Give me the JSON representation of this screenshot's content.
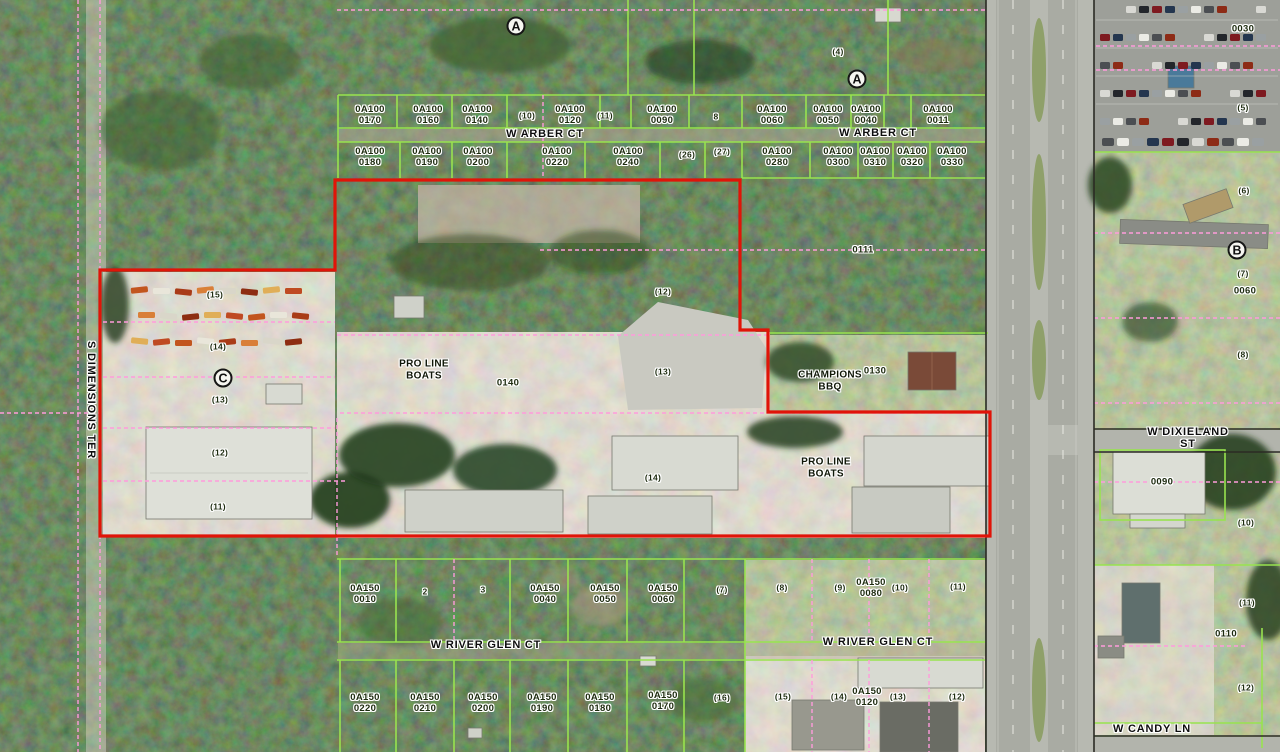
{
  "map": {
    "type": "county-gis-aerial-parcel-map",
    "colors": {
      "parcel_line_green": "#98e34f",
      "lot_boundary_pink": "#ff9bdc",
      "selected_parcel_red": "#e01408",
      "right_of_way_black": "#2b2b24",
      "label_ink": "#1d2b0f",
      "road_gray": "#b7b9b1"
    },
    "area_markers": [
      {
        "letter": "A",
        "x": 516,
        "y": 26
      },
      {
        "letter": "A",
        "x": 857,
        "y": 79
      },
      {
        "letter": "B",
        "x": 1237,
        "y": 250
      },
      {
        "letter": "C",
        "x": 223,
        "y": 378
      }
    ],
    "street_labels": [
      {
        "text": "W ARBER CT",
        "x": 545,
        "y": 134
      },
      {
        "text": "W ARBER CT",
        "x": 878,
        "y": 133
      },
      {
        "text": "S DIMENSIONS TER",
        "x": 91,
        "y": 400,
        "vertical": true
      },
      {
        "text": "W DIXIELAND ST",
        "x": 1188,
        "y": 438
      },
      {
        "text": "W RIVER GLEN CT",
        "x": 486,
        "y": 645
      },
      {
        "text": "W RIVER GLEN CT",
        "x": 878,
        "y": 642
      },
      {
        "text": "W CANDY LN",
        "x": 1152,
        "y": 729
      }
    ],
    "business_labels": [
      {
        "text": "PRO LINE\nBOATS",
        "x": 424,
        "y": 370
      },
      {
        "text": "CHAMPIONS\nBBQ",
        "x": 830,
        "y": 381
      },
      {
        "text": "PRO LINE\nBOATS",
        "x": 826,
        "y": 468
      }
    ],
    "parcel_labels": [
      {
        "text": "0A100\n0170",
        "x": 370,
        "y": 115
      },
      {
        "text": "0A100\n0160",
        "x": 428,
        "y": 115
      },
      {
        "text": "0A100\n0140",
        "x": 477,
        "y": 115
      },
      {
        "text": "0A100\n0120",
        "x": 570,
        "y": 115
      },
      {
        "text": "0A100\n0090",
        "x": 662,
        "y": 115
      },
      {
        "text": "0A100\n0060",
        "x": 772,
        "y": 115
      },
      {
        "text": "0A100\n0050",
        "x": 828,
        "y": 115
      },
      {
        "text": "0A100\n0040",
        "x": 866,
        "y": 115
      },
      {
        "text": "0A100\n0011",
        "x": 938,
        "y": 115
      },
      {
        "text": "0A100\n0180",
        "x": 370,
        "y": 157
      },
      {
        "text": "0A100\n0190",
        "x": 427,
        "y": 157
      },
      {
        "text": "0A100\n0200",
        "x": 478,
        "y": 157
      },
      {
        "text": "0A100\n0220",
        "x": 557,
        "y": 157
      },
      {
        "text": "0A100\n0240",
        "x": 628,
        "y": 157
      },
      {
        "text": "0A100\n0280",
        "x": 777,
        "y": 157
      },
      {
        "text": "0A100\n0300",
        "x": 838,
        "y": 157
      },
      {
        "text": "0A100\n0310",
        "x": 875,
        "y": 157
      },
      {
        "text": "0A100\n0320",
        "x": 912,
        "y": 157
      },
      {
        "text": "0A100\n0330",
        "x": 952,
        "y": 157
      },
      {
        "text": "0111",
        "x": 863,
        "y": 250
      },
      {
        "text": "0140",
        "x": 508,
        "y": 383
      },
      {
        "text": "0130",
        "x": 875,
        "y": 371
      },
      {
        "text": "0030",
        "x": 1243,
        "y": 29
      },
      {
        "text": "0060",
        "x": 1245,
        "y": 291
      },
      {
        "text": "0090",
        "x": 1162,
        "y": 482
      },
      {
        "text": "0110",
        "x": 1226,
        "y": 634
      },
      {
        "text": "0A150\n0010",
        "x": 365,
        "y": 594
      },
      {
        "text": "0A150\n0040",
        "x": 545,
        "y": 594
      },
      {
        "text": "0A150\n0050",
        "x": 605,
        "y": 594
      },
      {
        "text": "0A150\n0060",
        "x": 663,
        "y": 594
      },
      {
        "text": "0A150\n0080",
        "x": 871,
        "y": 588
      },
      {
        "text": "0A150\n0220",
        "x": 365,
        "y": 703
      },
      {
        "text": "0A150\n0210",
        "x": 425,
        "y": 703
      },
      {
        "text": "0A150\n0200",
        "x": 483,
        "y": 703
      },
      {
        "text": "0A150\n0190",
        "x": 542,
        "y": 703
      },
      {
        "text": "0A150\n0180",
        "x": 600,
        "y": 703
      },
      {
        "text": "0A150\n0170",
        "x": 663,
        "y": 701
      },
      {
        "text": "0A150\n0120",
        "x": 867,
        "y": 697
      }
    ],
    "lot_labels": [
      {
        "text": "(10)",
        "x": 527,
        "y": 116
      },
      {
        "text": "(11)",
        "x": 605,
        "y": 116
      },
      {
        "text": "8",
        "x": 716,
        "y": 117
      },
      {
        "text": "(26)",
        "x": 687,
        "y": 155
      },
      {
        "text": "(27)",
        "x": 722,
        "y": 152
      },
      {
        "text": "(4)",
        "x": 838,
        "y": 52
      },
      {
        "text": "(12)",
        "x": 663,
        "y": 292
      },
      {
        "text": "(13)",
        "x": 663,
        "y": 372
      },
      {
        "text": "(15)",
        "x": 215,
        "y": 295
      },
      {
        "text": "(14)",
        "x": 218,
        "y": 347
      },
      {
        "text": "(13)",
        "x": 220,
        "y": 400
      },
      {
        "text": "(12)",
        "x": 220,
        "y": 453
      },
      {
        "text": "(11)",
        "x": 218,
        "y": 507
      },
      {
        "text": "(14)",
        "x": 653,
        "y": 478
      },
      {
        "text": "(5)",
        "x": 1243,
        "y": 108
      },
      {
        "text": "(6)",
        "x": 1244,
        "y": 191
      },
      {
        "text": "(7)",
        "x": 1243,
        "y": 274
      },
      {
        "text": "(8)",
        "x": 1243,
        "y": 355
      },
      {
        "text": "(10)",
        "x": 1246,
        "y": 523
      },
      {
        "text": "(11)",
        "x": 1247,
        "y": 603
      },
      {
        "text": "(12)",
        "x": 1246,
        "y": 688
      },
      {
        "text": "2",
        "x": 425,
        "y": 592
      },
      {
        "text": "3",
        "x": 483,
        "y": 590
      },
      {
        "text": "(7)",
        "x": 722,
        "y": 590
      },
      {
        "text": "(8)",
        "x": 782,
        "y": 588
      },
      {
        "text": "(9)",
        "x": 840,
        "y": 588
      },
      {
        "text": "(10)",
        "x": 900,
        "y": 588
      },
      {
        "text": "(11)",
        "x": 958,
        "y": 587
      },
      {
        "text": "(16)",
        "x": 722,
        "y": 698
      },
      {
        "text": "(15)",
        "x": 783,
        "y": 697
      },
      {
        "text": "(14)",
        "x": 839,
        "y": 697
      },
      {
        "text": "(13)",
        "x": 898,
        "y": 697
      },
      {
        "text": "(12)",
        "x": 957,
        "y": 697
      }
    ]
  }
}
